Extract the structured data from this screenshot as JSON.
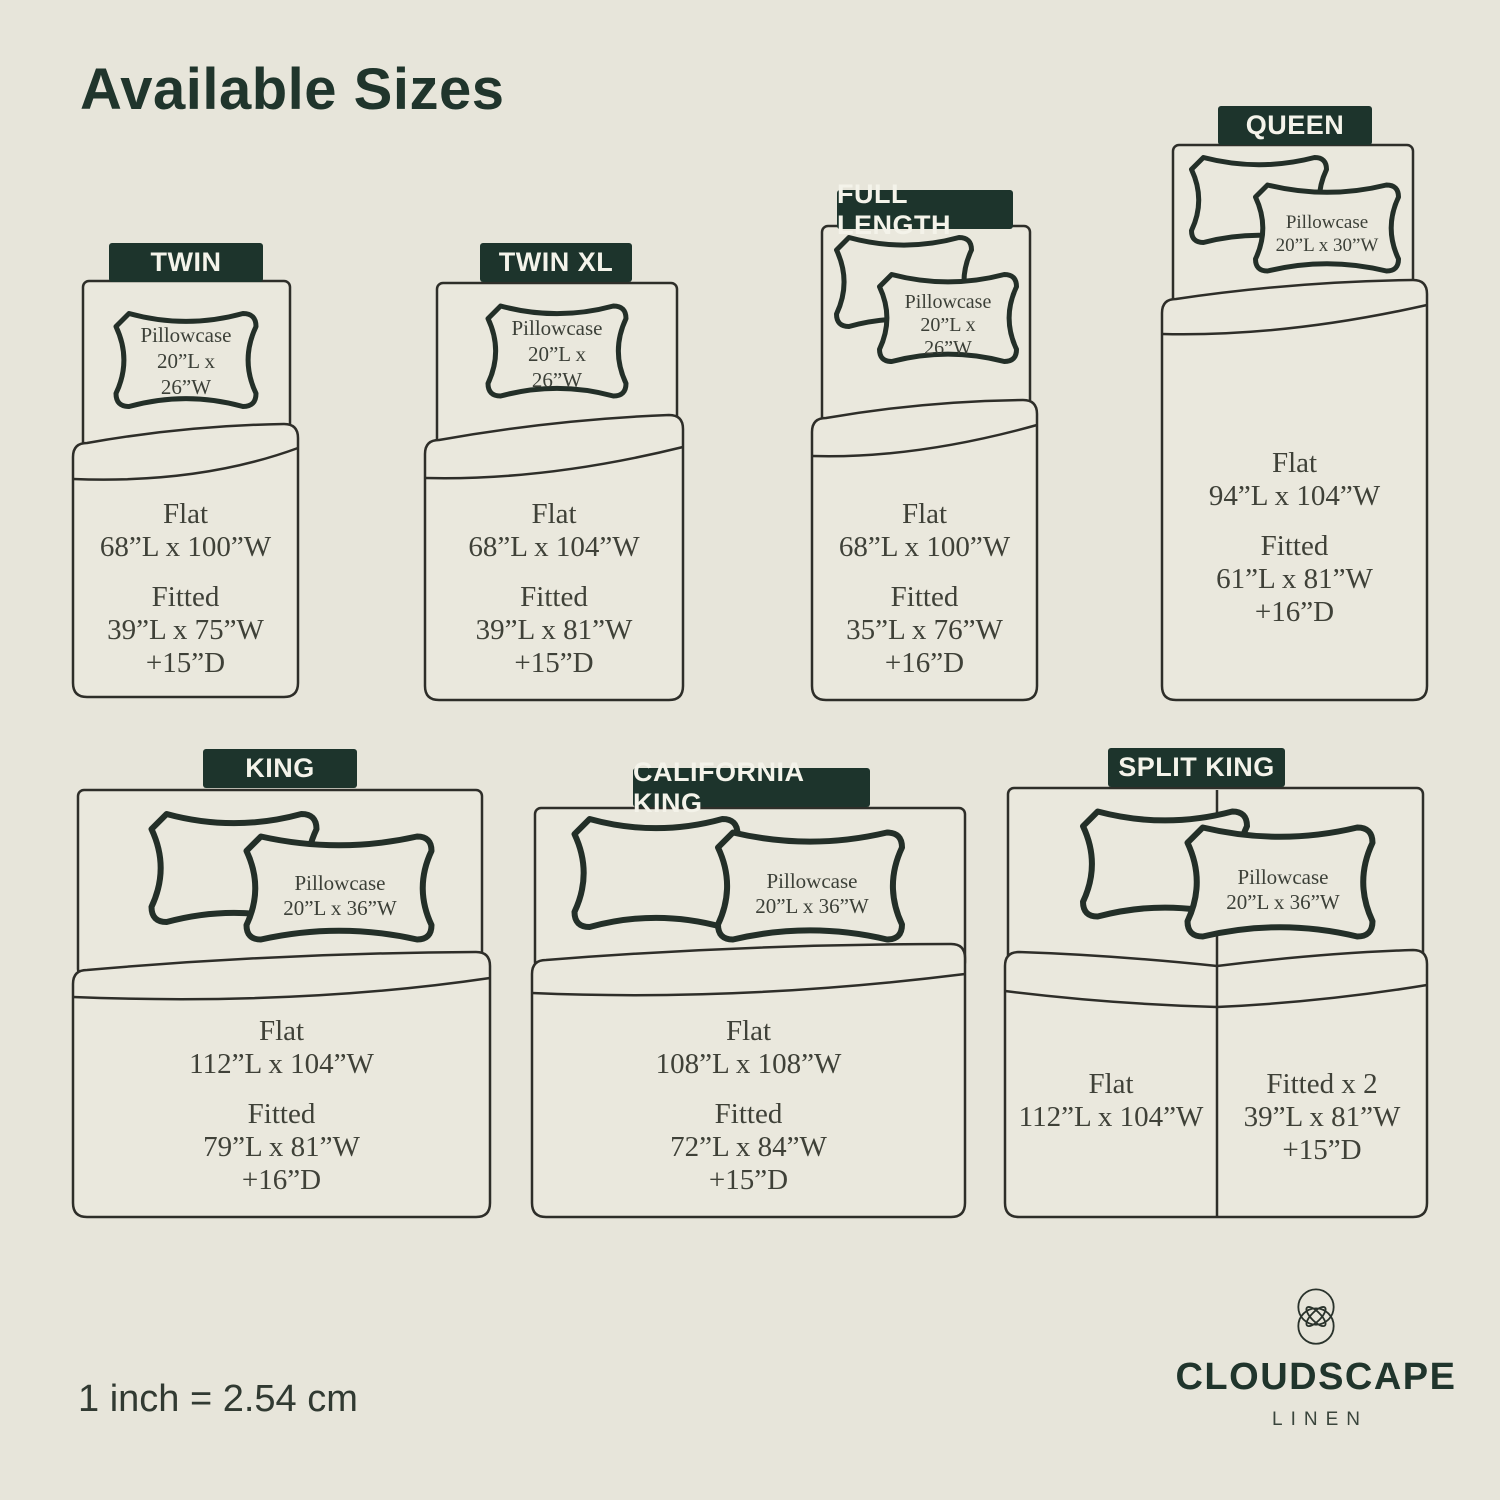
{
  "title": "Available Sizes",
  "scale_note": "1 inch = 2.54 cm",
  "brand": {
    "name": "CLOUDSCAPE",
    "tagline": "LINEN",
    "logo": "interlocking-circles-petal-mark"
  },
  "colors": {
    "background": "#e7e5da",
    "bed_fill": "#eae8dd",
    "outline": "#2e2e29",
    "pillow_outline": "#232f28",
    "label_bg": "#1d342c",
    "label_text": "#f4f3ea",
    "heading_text": "#20352c",
    "dimension_text": "#3f4138"
  },
  "sizes": [
    {
      "name": "TWIN",
      "pillow": {
        "label": "Pillowcase",
        "lines": [
          "20”L x",
          "26”W"
        ],
        "count": 1
      },
      "sheets": {
        "flat_label": "Flat",
        "flat": "68”L x 100”W",
        "fitted_label": "Fitted",
        "fitted": "39”L x 75”W",
        "depth": "+15”D"
      }
    },
    {
      "name": "TWIN XL",
      "pillow": {
        "label": "Pillowcase",
        "lines": [
          "20”L x",
          "26”W"
        ],
        "count": 1
      },
      "sheets": {
        "flat_label": "Flat",
        "flat": "68”L x 104”W",
        "fitted_label": "Fitted",
        "fitted": "39”L x 81”W",
        "depth": "+15”D"
      }
    },
    {
      "name": "FULL LENGTH",
      "pillow": {
        "label": "Pillowcase",
        "lines": [
          "20”L x",
          "26”W"
        ],
        "count": 2
      },
      "sheets": {
        "flat_label": "Flat",
        "flat": "68”L x 100”W",
        "fitted_label": "Fitted",
        "fitted": "35”L x 76”W",
        "depth": "+16”D"
      }
    },
    {
      "name": "QUEEN",
      "pillow": {
        "label": "Pillowcase",
        "lines": [
          "20”L x 30”W"
        ],
        "count": 2
      },
      "sheets": {
        "flat_label": "Flat",
        "flat": "94”L x 104”W",
        "fitted_label": "Fitted",
        "fitted": "61”L x 81”W",
        "depth": "+16”D"
      }
    },
    {
      "name": "KING",
      "pillow": {
        "label": "Pillowcase",
        "lines": [
          "20”L x 36”W"
        ],
        "count": 2
      },
      "sheets": {
        "flat_label": "Flat",
        "flat": "112”L x 104”W",
        "fitted_label": "Fitted",
        "fitted": "79”L x 81”W",
        "depth": "+16”D"
      }
    },
    {
      "name": "CALIFORNIA KING",
      "pillow": {
        "label": "Pillowcase",
        "lines": [
          "20”L x 36”W"
        ],
        "count": 2
      },
      "sheets": {
        "flat_label": "Flat",
        "flat": "108”L x 108”W",
        "fitted_label": "Fitted",
        "fitted": "72”L x 84”W",
        "depth": "+15”D"
      }
    },
    {
      "name": "SPLIT KING",
      "pillow": {
        "label": "Pillowcase",
        "lines": [
          "20”L x 36”W"
        ],
        "count": 2
      },
      "sheets_left": {
        "flat_label": "Flat",
        "flat": "112”L x 104”W"
      },
      "sheets_right": {
        "fitted_label": "Fitted x 2",
        "fitted": "39”L x 81”W",
        "depth": "+15”D"
      }
    }
  ]
}
